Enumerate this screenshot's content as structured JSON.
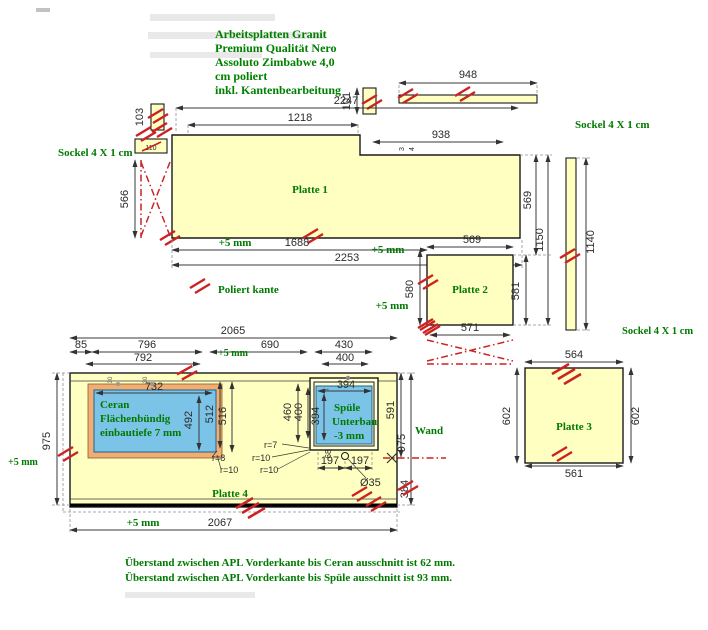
{
  "title": {
    "l1": "Arbeitsplatten Granit",
    "l2": "Premium Qualität Nero",
    "l3": "Assoluto Zimbabwe 4,0",
    "l4": "cm poliert",
    "l5": "inkl. Kantenbearbeitung"
  },
  "plates": {
    "p1": "Platte 1",
    "p2": "Platte 2",
    "p3": "Platte 3",
    "p4": "Platte 4"
  },
  "green_labels": {
    "sockel_left": "Sockel 4 X 1 cm",
    "sockel_right_top": "Sockel 4 X 1 cm",
    "sockel_right_bottom": "Sockel 4 X 1 cm",
    "poliert_kante": "Poliert kante",
    "wand": "Wand",
    "plus5": "+5 mm"
  },
  "ceran": {
    "l1": "Ceran",
    "l2": "Flächenbündig",
    "l3": "einbautiefe 7 mm"
  },
  "spuele": {
    "l1": "Spüle",
    "l2": "Unterbau",
    "l3": "-3 mm"
  },
  "notes": {
    "n1": "Überstand zwischen APL Vorderkante bis Ceran ausschnitt ist 62 mm.",
    "n2": "Überstand zwischen APL Vorderkante bis Spüle ausschnitt ist 93 mm."
  },
  "dims": {
    "d948": "948",
    "d101": "101",
    "d2247": "2247",
    "d1218": "1218",
    "d938": "938",
    "t3": "3",
    "t4": "4",
    "d103": "103",
    "d110": "110",
    "d90": "90",
    "d108": "108",
    "d566": "566",
    "d1688": "1688",
    "d2253": "2253",
    "d569h": "569",
    "d580": "580",
    "d581": "581",
    "d569v": "569",
    "d1150": "1150",
    "d571": "571",
    "d1140": "1140",
    "d564": "564",
    "d561": "561",
    "d602l": "602",
    "d602r": "602",
    "d2065": "2065",
    "d85": "85",
    "d796": "796",
    "d690": "690",
    "d430": "430",
    "d792": "792",
    "d400": "400",
    "d732": "732",
    "d492": "492",
    "d512": "512",
    "d516": "516",
    "d460": "460",
    "d400v": "400",
    "d394h": "394",
    "d394v": "394",
    "tick30a": "30",
    "tick30b": "30",
    "tick4": "4",
    "d197a": "197",
    "d197b": "197",
    "d68": "68",
    "dia35": "Ø35",
    "d384": "384",
    "d591": "591",
    "d975r": "975",
    "d975l": "975",
    "d2067": "2067",
    "r7": "r=7",
    "r8": "r=8",
    "r10a": "r=10",
    "r10b": "r=10",
    "r10c": "r=10"
  },
  "colors": {
    "plate_fill": "#FFFFC2",
    "cutout_blue": "#7CC3E8",
    "ceran_frame_orange": "#F2AE72",
    "label_green": "#007A00",
    "edge_mark_red": "#CC2222",
    "dim_line": "#3a3a3a"
  }
}
